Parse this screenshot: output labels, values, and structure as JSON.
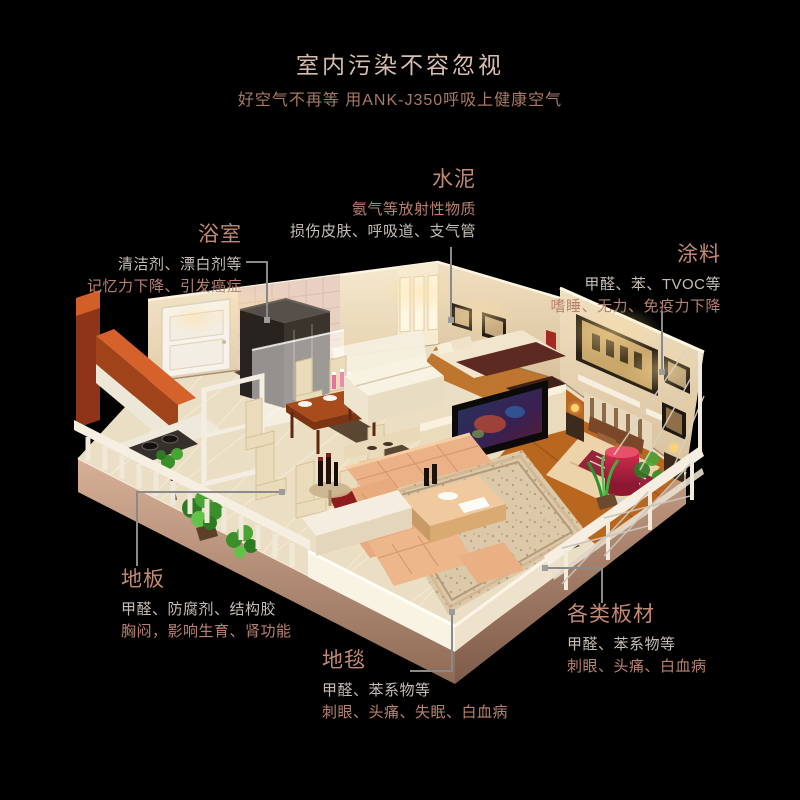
{
  "header": {
    "title": "室内污染不容忽视",
    "subtitle": "好空气不再等 用ANK-J350呼吸上健康空气"
  },
  "palette": {
    "background": "#000000",
    "title": "#d8bcae",
    "subtitle": "#a87a64",
    "callout_heading": "#c28a75",
    "callout_gray": "#c6beb6",
    "callout_rose": "#b98270",
    "connector": "#8a8a8a",
    "connector_dot": "#9c9c9c"
  },
  "callouts": [
    {
      "id": "cement",
      "label": "水泥",
      "line1": "氨气等放射性物质",
      "line1_color": "#b98270",
      "line2": "损伤皮肤、呼吸道、支气管",
      "line2_color": "#c6beb6",
      "align": "right"
    },
    {
      "id": "bathroom",
      "label": "浴室",
      "line1": "清洁剂、漂白剂等",
      "line1_color": "#c6beb6",
      "line2": "记忆力下降、引发癌症",
      "line2_color": "#b98270",
      "align": "right"
    },
    {
      "id": "paint",
      "label": "涂料",
      "line1": "甲醛、苯、TVOC等",
      "line1_color": "#c6beb6",
      "line2": "嗜睡、无力、免疫力下降",
      "line2_color": "#b98270",
      "align": "right"
    },
    {
      "id": "floor",
      "label": "地板",
      "line1": "甲醛、防腐剂、结构胶",
      "line1_color": "#c6beb6",
      "line2": "胸闷，影响生育、肾功能",
      "line2_color": "#b98270",
      "align": "left"
    },
    {
      "id": "carpet",
      "label": "地毯",
      "line1": "甲醛、苯系物等",
      "line1_color": "#c6beb6",
      "line2": "刺眼、头痛、失眠、白血病",
      "line2_color": "#b98270",
      "align": "left"
    },
    {
      "id": "boards",
      "label": "各类板材",
      "line1": "甲醛、苯系物等",
      "line1_color": "#c6beb6",
      "line2": "刺眼、头痛、白血病",
      "line2_color": "#b98270",
      "align": "left"
    }
  ]
}
